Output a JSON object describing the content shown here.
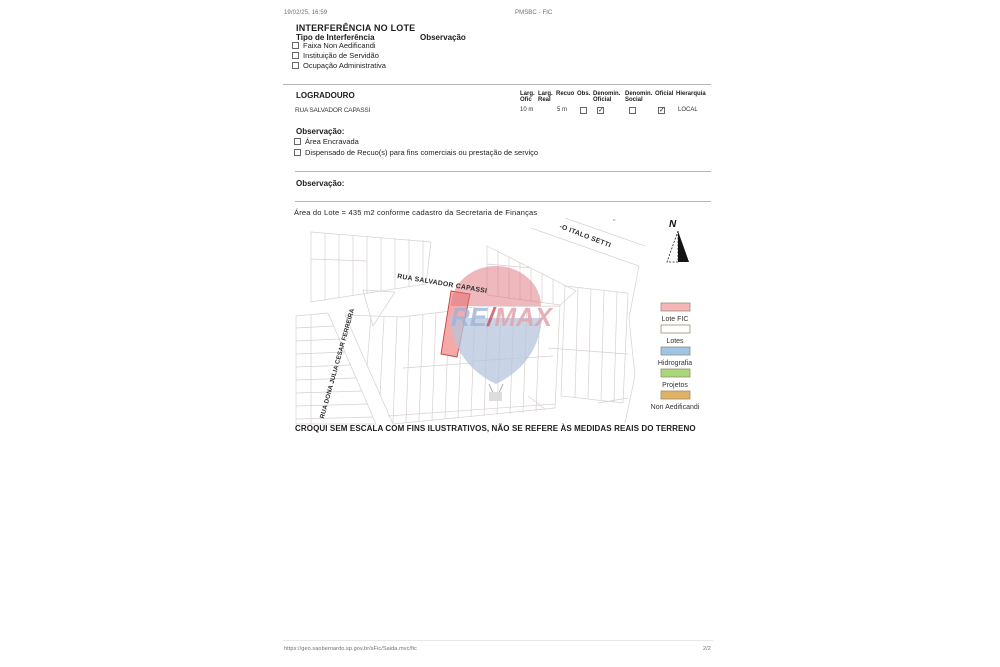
{
  "print_header": {
    "datetime": "19/02/25, 16:59",
    "doc": "PMSBC - FIC"
  },
  "interferencia": {
    "title": "INTERFERÊNCIA NO LOTE",
    "tipo_heading": "Tipo de Interferência",
    "observacao_heading": "Observação",
    "options": [
      {
        "label": "Faixa Non Aedificandi",
        "checked": false
      },
      {
        "label": "Instituição de Servidão",
        "checked": false
      },
      {
        "label": "Ocupação Administrativa",
        "checked": false
      }
    ]
  },
  "logradouro": {
    "heading": "LOGRADOURO",
    "columns": [
      {
        "l1": "Larg.",
        "l2": "Ofic"
      },
      {
        "l1": "Larg.",
        "l2": "Real"
      },
      {
        "l1": "Recuo",
        "l2": ""
      },
      {
        "l1": "Obs.",
        "l2": ""
      },
      {
        "l1": "Denomin.",
        "l2": "Oficial"
      },
      {
        "l1": "Denomin.",
        "l2": "Social"
      },
      {
        "l1": "Oficial",
        "l2": ""
      },
      {
        "l1": "Hierarquia",
        "l2": ""
      }
    ],
    "row": {
      "name": "RUA SALVADOR CAPASSI",
      "larg_ofic": "10 m",
      "larg_real": "",
      "recuo": "5 m",
      "obs_checked": false,
      "denomin_oficial_checked": true,
      "denomin_social_checked": false,
      "oficial_checked": true,
      "hierarquia": "LOCAL"
    }
  },
  "observacao1": {
    "heading": "Observação:",
    "options": [
      {
        "label": "Área Encravada",
        "checked": false
      },
      {
        "label": "Dispensado de Recuo(s) para fins comerciais ou prestação de serviço",
        "checked": false
      }
    ]
  },
  "observacao2": {
    "heading": "Observação:"
  },
  "map": {
    "note": "Área do Lote = 435 m2 conforme cadastro da Secretaria de Finanças",
    "caption": "CROQUI SEM ESCALA COM FINS ILUSTRATIVOS, NÃO SE REFERE ÀS MEDIDAS REAIS DO TERRENO",
    "north_label": "N",
    "corner_mark": "’’",
    "streets": {
      "salvador": "RUA SALVADOR CAPASSI",
      "dona_julia": "RUA DONA  JULIA CESAR FERREIRA",
      "italo_setti": "-O ITALO SETTI"
    },
    "watermark": {
      "re": "RE",
      "slash": "/",
      "max": "MAX"
    },
    "lote_fic_color": "#f4aaa8",
    "lote_fic_border": "#c84040",
    "legend": [
      {
        "label": "Lote FIC",
        "color": "#f6b6b8"
      },
      {
        "label": "Lotes",
        "color": "#ffffff"
      },
      {
        "label": "Hidrografia",
        "color": "#9ec4e8"
      },
      {
        "label": "Projetos",
        "color": "#a8d878"
      },
      {
        "label": "Non Aedificandi",
        "color": "#dfb264"
      }
    ]
  },
  "ui": {
    "check_glyph": "✓"
  },
  "print_footer": {
    "url": "https://geo.saobernardo.sp.gov.br/sFic/Saida.mvc/fic",
    "page": "2/2"
  }
}
